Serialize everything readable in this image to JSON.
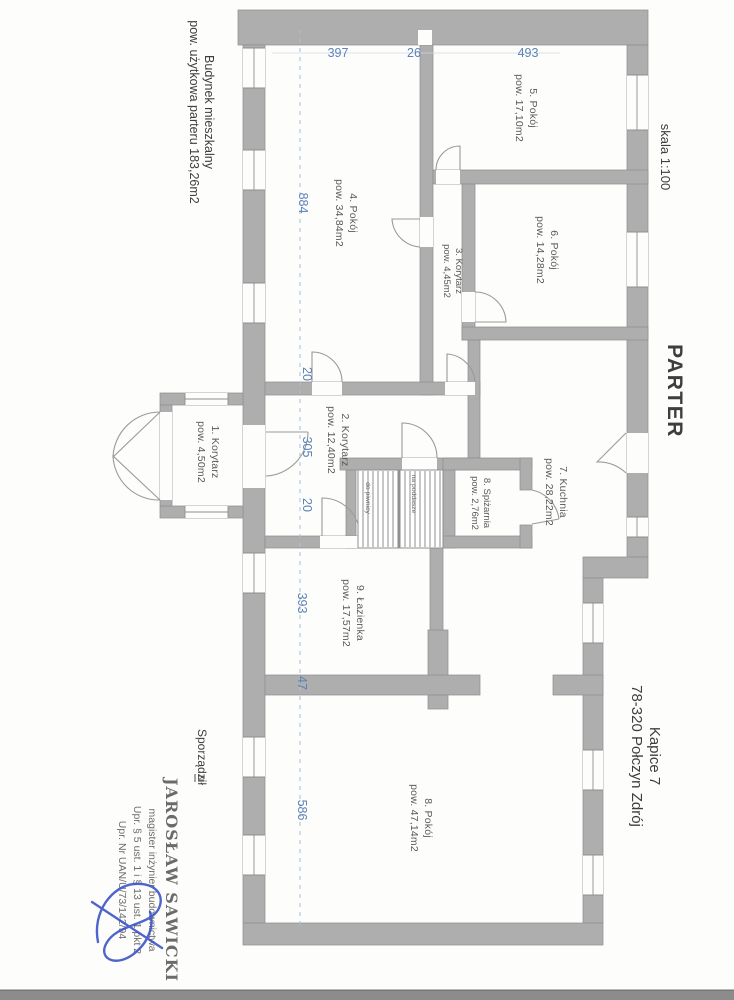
{
  "page": {
    "building_label": {
      "line1": "Budynek mieszkalny",
      "line2": "pow. użytkowa parteru 183,26m2"
    },
    "scale_label": "skala 1:100",
    "floor_title": "PARTER",
    "address": {
      "line1": "Kapice 7",
      "line2": "78-320 Połczyn Zdrój"
    },
    "prepared_by_label": "Sporządził",
    "north_mark": "N"
  },
  "rooms": [
    {
      "name": "1. Korytarz",
      "area": "pow. 4,50m2"
    },
    {
      "name": "2. Korytarz",
      "area": "pow. 12,40m2"
    },
    {
      "name": "3. Korytarz",
      "area": "pow. 4,45m2"
    },
    {
      "name": "4. Pokój",
      "area": "pow. 34,84m2"
    },
    {
      "name": "5. Pokój",
      "area": "pow. 17,10m2"
    },
    {
      "name": "6. Pokój",
      "area": "pow. 14,28m2"
    },
    {
      "name": "7. Kuchnia",
      "area": "pow. 28,22m2"
    },
    {
      "name": "8. Spiżarnia",
      "area": "pow. 2,76m2"
    },
    {
      "name": "9. Łazienka",
      "area": "pow. 17,57m2"
    },
    {
      "name": "8. Pokój",
      "area": "pow. 47,14m2"
    }
  ],
  "stairs": {
    "to_basement": "do piwnicy",
    "to_attic": "na poddasze"
  },
  "dimensions": {
    "top": [
      "397",
      "26",
      "493"
    ],
    "side": [
      "884",
      "20",
      "305",
      "20",
      "393",
      "47",
      "586"
    ]
  },
  "stamp": {
    "line1": "JAROSŁAW SAWICKI",
    "line2": "magister inżynier budownictwa",
    "line3": "Upr. § 5 ust. 1 i § 13 ust. 1 pkt 2",
    "line4": "Upr. Nr UAN/U/73/142/94"
  },
  "colors": {
    "wall": "#aeaeae",
    "wall_edge": "#8f8f8f",
    "dimension_blue": "#5b82b8",
    "stamp_violet": "#5f5fae",
    "signature_blue": "#3b55c8",
    "label_gray": "#595959",
    "text_black": "#3e3e3e",
    "scan_band": "#8c8c8c"
  }
}
